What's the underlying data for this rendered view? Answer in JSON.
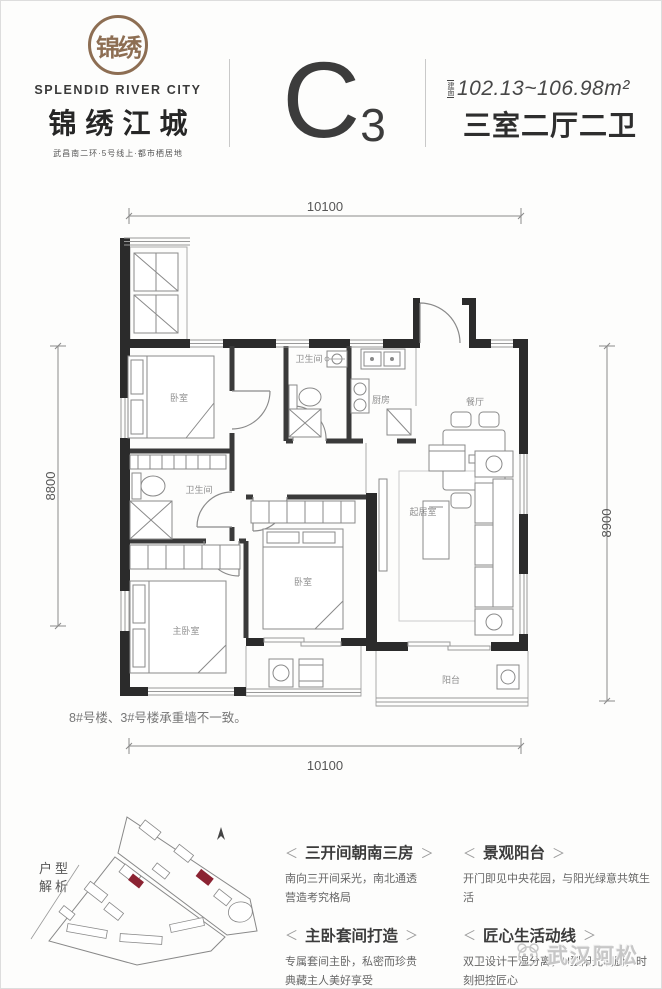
{
  "header": {
    "seal_text": "锦绣",
    "brand_en": "SPLENDID RIVER CITY",
    "brand_cn": "锦绣江城",
    "tagline": "武昌南二环·5号线上·都市栖居地",
    "unit_letter": "C",
    "unit_number": "3",
    "area_tag": "建面",
    "area_value": "102.13~106.98m²",
    "layout_label": "三室二厅二卫"
  },
  "floorplan": {
    "dim_top": "10100",
    "dim_bottom": "10100",
    "dim_left": "8800",
    "dim_right": "8900",
    "note": "8#号楼、3#号楼承重墙不一致。",
    "rooms": {
      "bedroom_top": "卧室",
      "bath_left": "卫生间",
      "master_bedroom": "主卧室",
      "bath_center": "卫生间",
      "kitchen": "厨房",
      "dining": "餐厅",
      "bedroom_center": "卧室",
      "living": "起居室",
      "balcony": "阳台"
    },
    "wall_color": "#2b2b2b"
  },
  "analysis": {
    "map_label_line1": "户型",
    "map_label_line2": "解析",
    "highlight_color": "#8b2332",
    "bracket_left": "＜",
    "bracket_right": "＞",
    "features": [
      {
        "title": "三开间朝南三房",
        "desc": "南向三开间采光，南北通透\n营造考究格局"
      },
      {
        "title": "景观阳台",
        "desc": "开门即见中央花园，与阳光绿意共筑生活"
      },
      {
        "title": "主卧套间打造",
        "desc": "专属套间主卧，私密而珍贵\n典藏主人美好享受"
      },
      {
        "title": "匠心生活动线",
        "desc": "双卫设计干湿分离，U型阳光明厨，时刻把控匠心"
      }
    ]
  },
  "watermark": "武汉阿松"
}
